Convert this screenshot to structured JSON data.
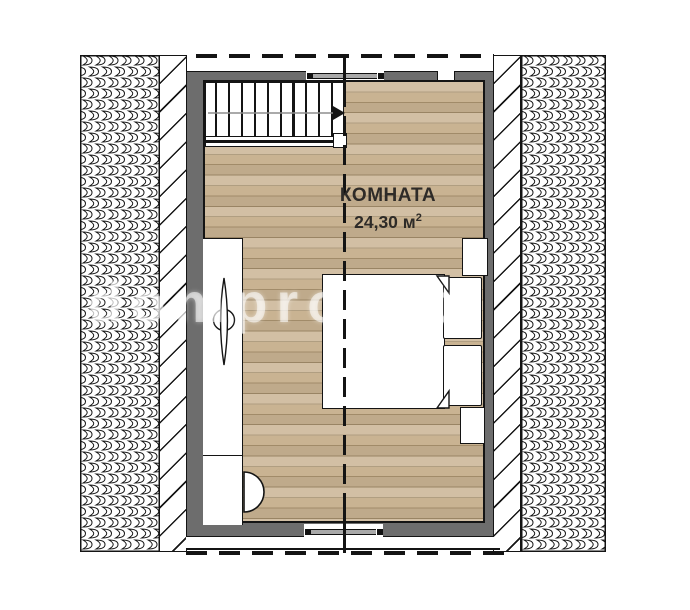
{
  "plan": {
    "room_label": "КОМНАТА",
    "room_area_value": "24,30 м",
    "room_area_sup": "2"
  },
  "watermark": {
    "text": "domproekt"
  },
  "stairs": {
    "tread_count": 10,
    "direction": "right"
  },
  "colors": {
    "floor_wood": "#c9b392",
    "floor_seam": "#a18b69",
    "wall_gray": "#6d6d6d",
    "outline": "#141414",
    "paper": "#ffffff"
  }
}
